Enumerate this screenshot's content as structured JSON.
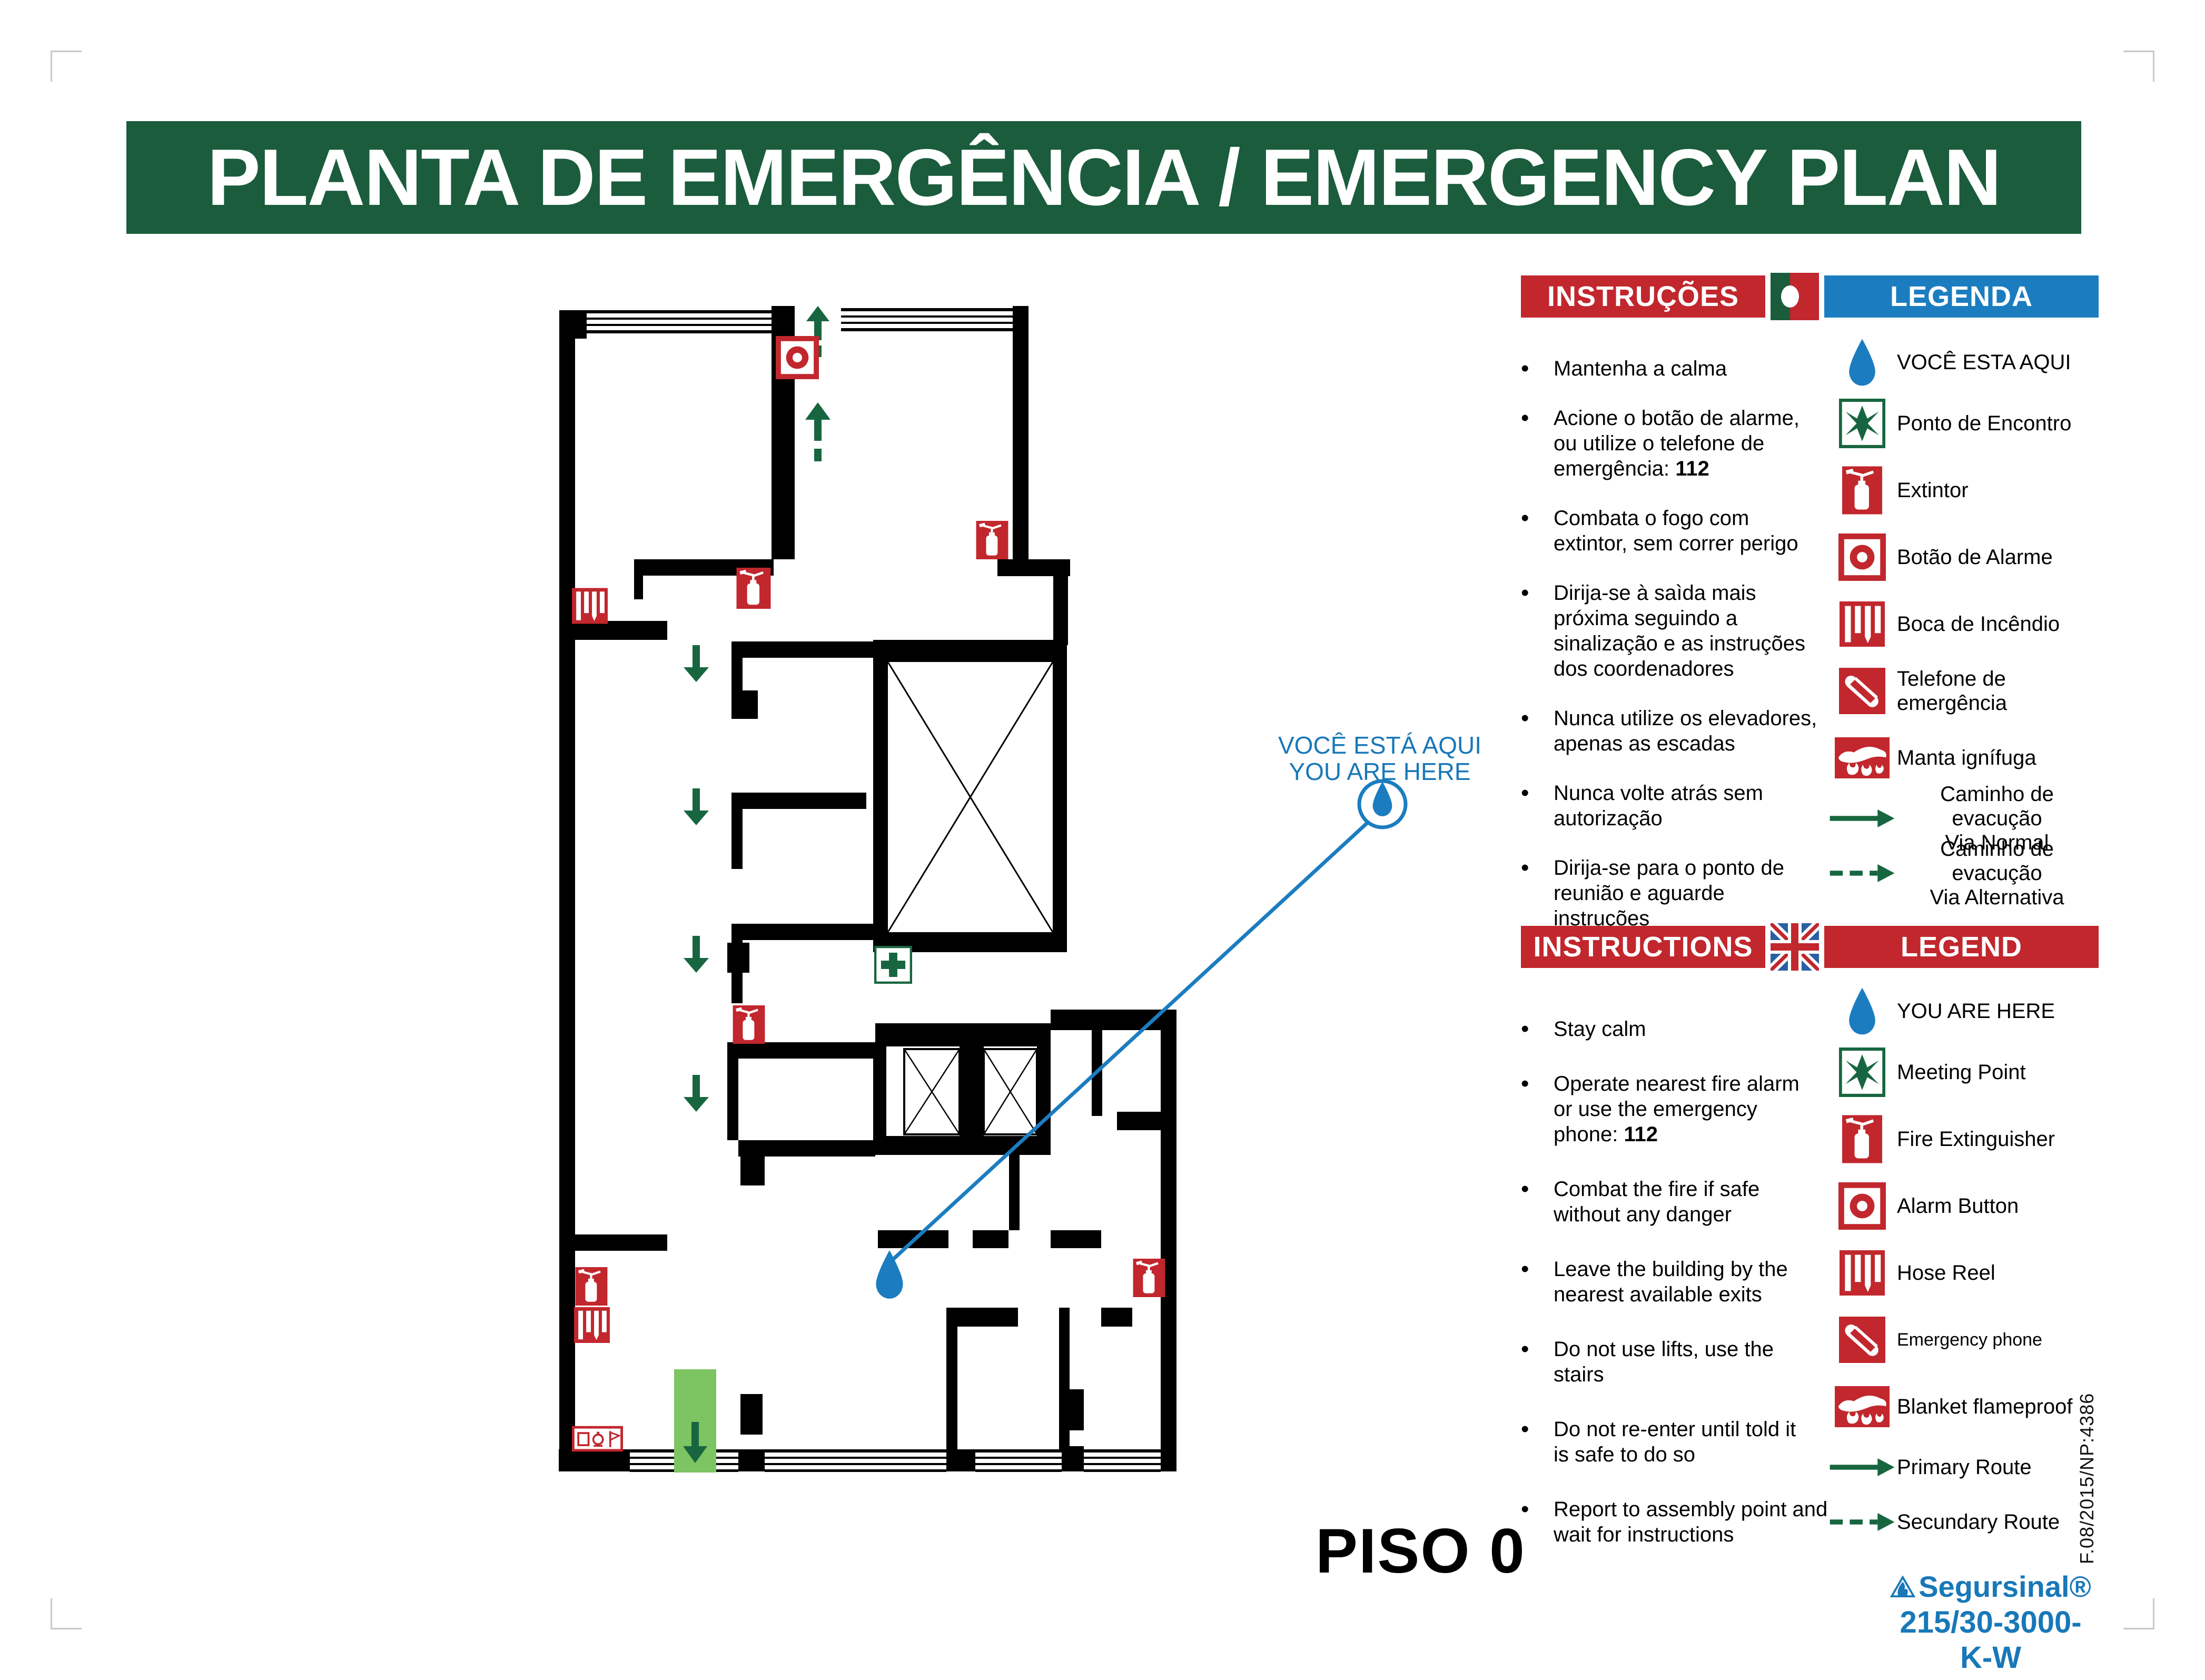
{
  "title": "PLANTA DE EMERGÊNCIA / EMERGENCY PLAN",
  "floor_label": "PISO 0",
  "ui": {
    "bullet": "•"
  },
  "callout": {
    "text": "VOCÊ ESTÁ AQUI\nYOU ARE HERE"
  },
  "colors": {
    "banner_green": "#1A5C3C",
    "header_red": "#C1272D",
    "header_blue": "#1B7DC0",
    "accent_blue": "#1878B8",
    "route_green": "#17663F",
    "exit_band_green": "#7DC462"
  },
  "sections": {
    "pt": {
      "instructions_title": "INSTRUÇÕES",
      "legend_title": "LEGENDA",
      "flag": "portugal-flag",
      "instructions": [
        {
          "text": "Mantenha a calma"
        },
        {
          "text": "Acione o botão de alarme,\nou utilize o telefone de\nemergência: ",
          "strong": "112"
        },
        {
          "text": "Combata o fogo com\nextintor, sem correr perigo"
        },
        {
          "text": "Dirija-se à saìda mais\npróxima seguindo a\nsinalização e as instruções\ndos coordenadores"
        },
        {
          "text": "Nunca utilize os elevadores,\napenas as escadas"
        },
        {
          "text": "Nunca volte atrás sem\nautorização"
        },
        {
          "text": "Dirija-se para o ponto de\nreunião e aguarde instruções"
        }
      ],
      "legend": [
        {
          "icon": "you-are-here-icon",
          "label": "VOCÊ ESTA AQUI"
        },
        {
          "icon": "meeting-point-icon",
          "label": "Ponto de Encontro"
        },
        {
          "icon": "fire-extinguisher-icon",
          "label": "Extintor"
        },
        {
          "icon": "alarm-button-icon",
          "label": "Botão de Alarme"
        },
        {
          "icon": "hose-reel-icon",
          "label": "Boca de Incêndio"
        },
        {
          "icon": "emergency-phone-icon",
          "label": "Telefone de emergência"
        },
        {
          "icon": "fire-blanket-icon",
          "label": "Manta ignífuga"
        },
        {
          "icon": "primary-route-icon",
          "label": "Caminho de evacução\nVia Normal"
        },
        {
          "icon": "secondary-route-icon",
          "label": "Caminho de evacução\nVia Alternativa"
        }
      ]
    },
    "en": {
      "instructions_title": "INSTRUCTIONS",
      "legend_title": "LEGEND",
      "flag": "uk-flag",
      "instructions": [
        {
          "text": "Stay calm"
        },
        {
          "text": "Operate nearest fire alarm\nor use the emergency\nphone: ",
          "strong": "112"
        },
        {
          "text": "Combat the fire if safe\nwithout any danger"
        },
        {
          "text": "Leave the building by the\nnearest available exits"
        },
        {
          "text": "Do not use lifts, use the\nstairs"
        },
        {
          "text": "Do not re-enter until told it\nis safe to do so"
        },
        {
          "text": "Report to assembly point and\nwait for instructions"
        }
      ],
      "legend": [
        {
          "icon": "you-are-here-icon",
          "label": "YOU ARE HERE"
        },
        {
          "icon": "meeting-point-icon",
          "label": "Meeting Point"
        },
        {
          "icon": "fire-extinguisher-icon",
          "label": "Fire Extinguisher"
        },
        {
          "icon": "alarm-button-icon",
          "label": "Alarm Button"
        },
        {
          "icon": "hose-reel-icon",
          "label": "Hose Reel"
        },
        {
          "icon": "emergency-phone-icon",
          "label": "Emergency phone"
        },
        {
          "icon": "fire-blanket-icon",
          "label": "Blanket flameproof"
        },
        {
          "icon": "primary-route-icon",
          "label": "Primary Route"
        },
        {
          "icon": "secondary-route-icon",
          "label": "Secundary Route"
        }
      ]
    }
  },
  "plan": {
    "marker_types": [
      "fire-extinguisher",
      "hose-reel",
      "alarm-button",
      "first-aid",
      "alarm-panel",
      "you-are-here",
      "evacuation-route",
      "exit-band",
      "lift-shaft",
      "stair-shaft"
    ]
  },
  "footer": {
    "brand": "Segursinal®",
    "code": "215/30-3000-K-W",
    "doc_ref": "F.08/2015/NP:4386"
  }
}
